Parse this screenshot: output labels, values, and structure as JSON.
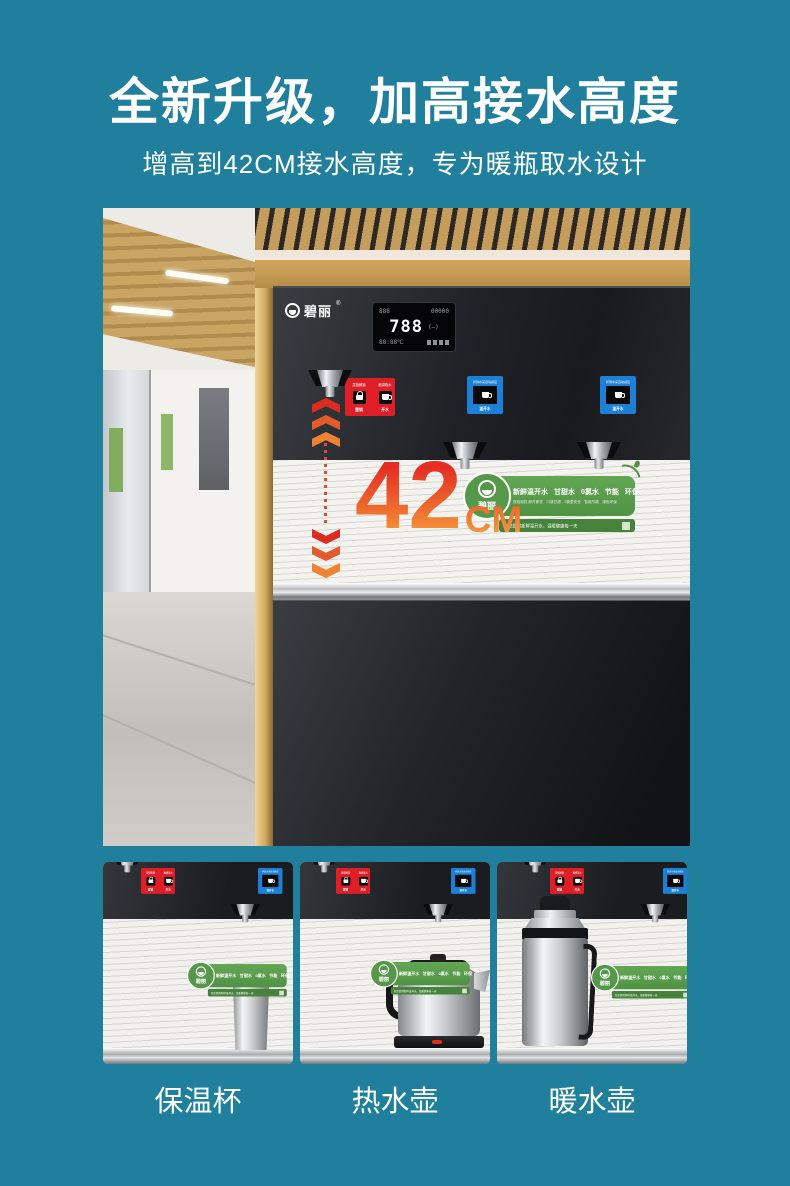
{
  "page": {
    "title": "全新升级，加高接水高度",
    "subtitle": "增高到42CM接水高度，专为暖瓶取水设计"
  },
  "machine": {
    "brand": "碧丽",
    "brand_reg": "®",
    "display": {
      "row1_left": "888",
      "row1_right": "00000",
      "main_value": "788",
      "main_side": "(—)",
      "row3_left": "88:88℃"
    },
    "boiling_label": {
      "left_top": "童锁解锁",
      "left_bottom": "童锁",
      "right_top": "触摸取水",
      "right_bottom": "开水"
    },
    "warm_label": {
      "top": "杯到水来自动感应",
      "bottom": "温开水"
    }
  },
  "callout": {
    "value": "42",
    "unit": "CM"
  },
  "banner": {
    "brand": "碧丽",
    "features": [
      "新鲜温开水",
      "甘甜水",
      "0氯水",
      "节能",
      "环保"
    ],
    "details": [
      "现烧现饮 即开即饮",
      "口感甘甜",
      "0氯更安全",
      "智能节能",
      "绿色环保"
    ],
    "slogan": "为您提供新鲜温开水，温暖健康每一天"
  },
  "thumbnails": [
    {
      "caption": "保温杯"
    },
    {
      "caption": "热水壶"
    },
    {
      "caption": "暖水壶"
    }
  ],
  "colors": {
    "background": "#1F7F9C",
    "gradient_red": "#E52D23",
    "gradient_orange": "#F5A03F",
    "banner_green": "#55984A",
    "label_red": "#DE1F28",
    "label_blue": "#1B80D6"
  }
}
